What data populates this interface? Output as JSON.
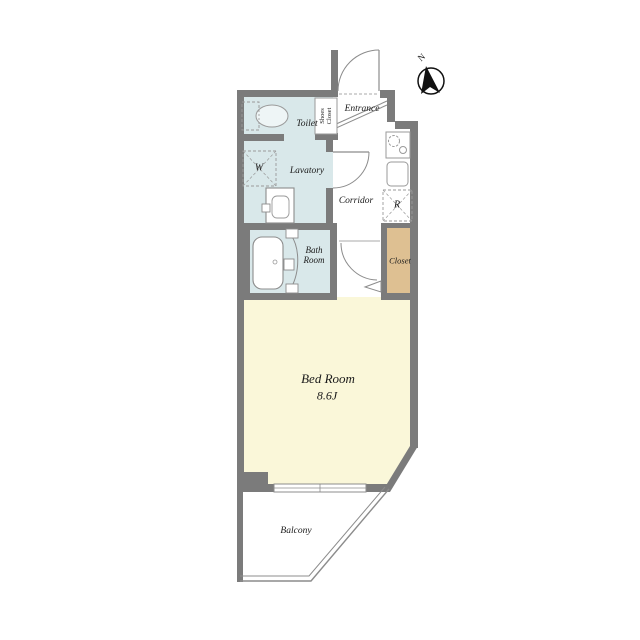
{
  "colors": {
    "wall": "#7b7b7b",
    "wet": "#d9e8ea",
    "bed": "#faf7d9",
    "tan": "#dec092",
    "line": "#8c8c8c",
    "ink": "#1a1a1a",
    "bg": "#ffffff"
  },
  "rooms": {
    "toilet": {
      "label": "Toilet"
    },
    "shoes_closet": {
      "line1": "Shoes",
      "line2": "Closet"
    },
    "entrance": {
      "label": "Entrance"
    },
    "lavatory": {
      "label": "Lavatory"
    },
    "washer": {
      "label": "W"
    },
    "corridor": {
      "label": "Corridor"
    },
    "refrigerator": {
      "label": "R"
    },
    "bath": {
      "line1": "Bath",
      "line2": "Room"
    },
    "closet": {
      "label": "Closet"
    },
    "bedroom": {
      "label": "Bed Room",
      "size": "8.6J"
    },
    "balcony": {
      "label": "Balcony"
    }
  },
  "compass": {
    "label": "N"
  }
}
